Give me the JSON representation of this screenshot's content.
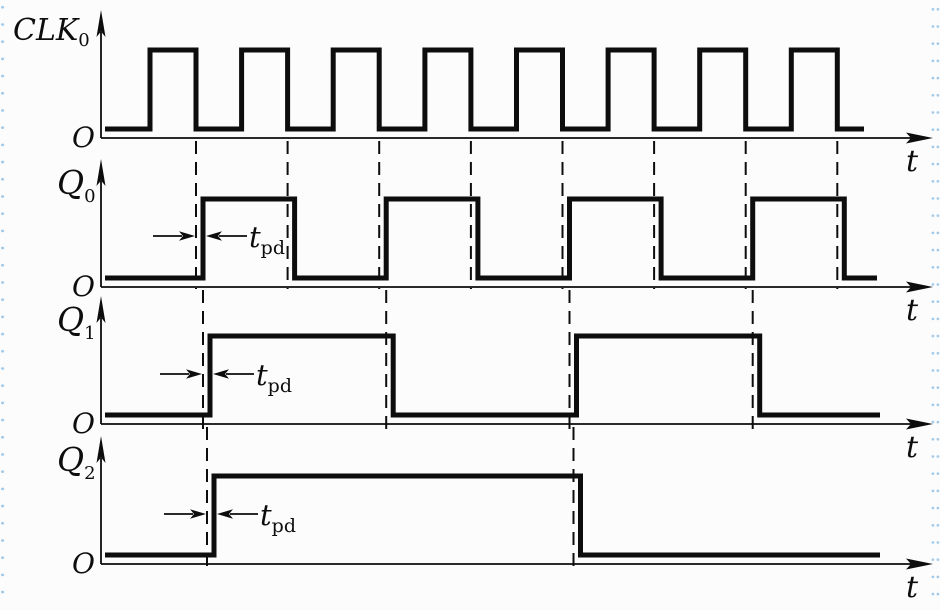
{
  "figure": {
    "type": "ripple-counter timing diagram",
    "background": "#fcfcfc",
    "ink": "#0d0d0d",
    "edge_dot_color": "#a3cbe9",
    "origin_label": "O",
    "time_label": "t",
    "tpd": {
      "base": "t",
      "sub": "pd"
    },
    "t_pd_px": 7,
    "clock": {
      "pulses": 8,
      "period_px": 91.6,
      "high_px": 46
    },
    "signals": [
      {
        "name": "CLK0",
        "label": {
          "base": "CLK",
          "sub": "0"
        },
        "axis_y": 138,
        "high_y": 50,
        "low_y": 129,
        "wave": {
          "x_start": 105,
          "x_end": 864,
          "start_level": 0,
          "toggles": [
            150,
            196,
            241.6,
            287.6,
            333.2,
            379.2,
            424.9,
            470.9,
            516.5,
            562.5,
            608.1,
            654.1,
            699.7,
            745.7,
            791.3,
            837.3
          ]
        },
        "guides": [],
        "tpd_annotation": null
      },
      {
        "name": "Q0",
        "label": {
          "base": "Q",
          "sub": "0"
        },
        "axis_y": 287,
        "high_y": 199,
        "low_y": 278,
        "wave": {
          "x_start": 105,
          "x_end": 877,
          "start_level": 0,
          "toggles": [
            203,
            294.6,
            386.2,
            477.9,
            569.5,
            661.1,
            752.7,
            844.3
          ]
        },
        "guides": [
          196,
          287.6,
          379.2,
          470.9,
          562.5,
          654.1,
          745.7,
          837.3
        ],
        "tpd_annotation": {
          "y": 236,
          "guide_x": 196,
          "edge_x": 203
        }
      },
      {
        "name": "Q1",
        "label": {
          "base": "Q",
          "sub": "1"
        },
        "axis_y": 424,
        "high_y": 336,
        "low_y": 415,
        "wave": {
          "x_start": 105,
          "x_end": 880,
          "start_level": 0,
          "toggles": [
            210,
            393.2,
            576.5,
            759.7
          ]
        },
        "guides": [
          203,
          386.2,
          569.5,
          752.7
        ],
        "tpd_annotation": {
          "y": 374,
          "guide_x": 203,
          "edge_x": 210
        }
      },
      {
        "name": "Q2",
        "label": {
          "base": "Q",
          "sub": "2"
        },
        "axis_y": 564,
        "high_y": 476,
        "low_y": 555,
        "wave": {
          "x_start": 105,
          "x_end": 880,
          "start_level": 0,
          "toggles": [
            214,
            580.5
          ]
        },
        "guides": [
          207,
          573.5
        ],
        "tpd_annotation": {
          "y": 514,
          "guide_x": 207,
          "edge_x": 214
        }
      }
    ]
  }
}
